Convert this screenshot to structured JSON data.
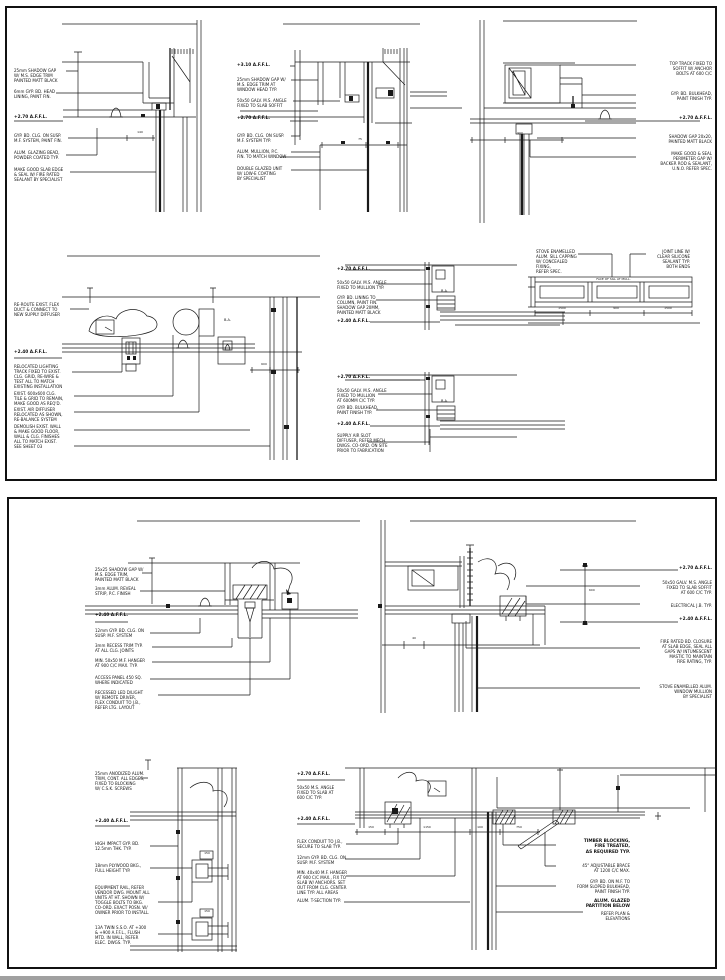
{
  "page": {
    "background": "#ffffff",
    "sheet_border_color": "#111111",
    "line_color": "#1a1a1a",
    "bottom_strip_color": "#a0a0a0"
  },
  "sheet1": {
    "callouts": [
      {
        "name": "d1-note-shadow-gap",
        "x": 14,
        "y": 68,
        "w": 52,
        "text": "25mm SHADOW GAP\nW/ M.S. EDGE TRIM\nPAINTED MATT BLACK"
      },
      {
        "name": "d1-note-head-lining",
        "x": 14,
        "y": 89,
        "w": 52,
        "text": "6mm GYP. BD. HEAD\nLINING, PAINT FIN."
      },
      {
        "name": "d1-level-affl",
        "x": 14,
        "y": 115,
        "w": 52,
        "bold": true,
        "text": "+2.70 A.F.F.L."
      },
      {
        "name": "d1-note-ceiling",
        "x": 14,
        "y": 133,
        "w": 56,
        "text": "GYP. BD. CLG. ON SUSP.\nM.F. SYSTEM, PAINT FIN."
      },
      {
        "name": "d1-note-glazing-bead",
        "x": 14,
        "y": 150,
        "w": 52,
        "text": "ALUM. GLAZING BEAD,\nPOWDER COATED TYP."
      },
      {
        "name": "d1-note-slab-seal",
        "x": 14,
        "y": 167,
        "w": 54,
        "text": "MAKE GOOD SLAB EDGE\n& SEAL W/ FIRE RATED\nSEALANT BY SPECIALIST"
      },
      {
        "name": "d1-dim-head",
        "x": 128,
        "y": 131,
        "w": 24,
        "size": 3,
        "align": "center",
        "text": "140"
      },
      {
        "name": "d2-level-top",
        "x": 237,
        "y": 63,
        "w": 52,
        "bold": true,
        "text": "+3.10 A.F.F.L."
      },
      {
        "name": "d2-note-shadow-gap",
        "x": 237,
        "y": 77,
        "w": 54,
        "text": "25mm SHADOW GAP W/\nM.S. EDGE TRIM AT\nWINDOW HEAD TYP."
      },
      {
        "name": "d2-note-angle",
        "x": 237,
        "y": 98,
        "w": 54,
        "text": "50x50 GALV. M.S. ANGLE\nFIXED TO SLAB SOFFIT"
      },
      {
        "name": "d2-level-affl",
        "x": 237,
        "y": 116,
        "w": 52,
        "bold": true,
        "text": "+2.70 A.F.F.L."
      },
      {
        "name": "d2-note-ceiling",
        "x": 237,
        "y": 133,
        "w": 54,
        "text": "GYP. BD. CLG. ON SUSP.\nM.F. SYSTEM TYP."
      },
      {
        "name": "d2-note-mullion",
        "x": 237,
        "y": 149,
        "w": 54,
        "text": "ALUM. MULLION, P.C.\nFIN. TO MATCH WINDOW"
      },
      {
        "name": "d2-note-glazing",
        "x": 237,
        "y": 166,
        "w": 54,
        "text": "DOUBLE GLAZED UNIT\nW/ LOW-E COATING\nBY SPECIALIST"
      },
      {
        "name": "d2-dim-head",
        "x": 348,
        "y": 138,
        "w": 24,
        "size": 3,
        "align": "center",
        "text": "75"
      },
      {
        "name": "d3-note-track",
        "x": 638,
        "y": 61,
        "w": 74,
        "align": "right",
        "text": "TOP TRACK FIXED TO\nSOFFIT W/ ANCHOR\nBOLTS AT 600 C/C"
      },
      {
        "name": "d3-note-bulkhead",
        "x": 638,
        "y": 91,
        "w": 74,
        "align": "right",
        "text": "GYP. BD. BULKHEAD,\nPAINT FINISH TYP."
      },
      {
        "name": "d3-level-affl",
        "x": 638,
        "y": 116,
        "w": 74,
        "align": "right",
        "bold": true,
        "text": "+2.70 A.F.F.L."
      },
      {
        "name": "d3-note-shadow",
        "x": 638,
        "y": 134,
        "w": 74,
        "align": "right",
        "text": "SHADOW GAP 20x20,\nPAINTED MATT BLACK"
      },
      {
        "name": "d3-note-seal",
        "x": 638,
        "y": 151,
        "w": 74,
        "align": "right",
        "text": "MAKE GOOD & SEAL\nPERIMETER GAP W/\nBACKER ROD & SEALANT,\nU.N.O. REFER SPEC."
      },
      {
        "name": "d3-dim-sill",
        "x": 505,
        "y": 132,
        "w": 30,
        "size": 3,
        "align": "center",
        "text": "900"
      },
      {
        "name": "d4-note-flex",
        "x": 14,
        "y": 302,
        "w": 56,
        "text": "RE-ROUTE EXIST. FLEX\nDUCT & CONNECT TO\nNEW SUPPLY DIFFUSER"
      },
      {
        "name": "d4-level",
        "x": 14,
        "y": 350,
        "w": 52,
        "bold": true,
        "text": "+2.40 A.F.F.L."
      },
      {
        "name": "d4-note-track",
        "x": 14,
        "y": 364,
        "w": 58,
        "text": "RELOCATED LIGHTING\nTRACK FIXED TO EXIST.\nCLG. GRID, RE-WIRE &\nTEST ALL TO MATCH\nEXISTING INSTALLATION"
      },
      {
        "name": "d4-note-tile",
        "x": 14,
        "y": 391,
        "w": 58,
        "text": "EXIST. 600x600 CLG.\nTILE & GRID TO REMAIN,\nMAKE GOOD AS REQ'D."
      },
      {
        "name": "d4-note-diffuser",
        "x": 14,
        "y": 407,
        "w": 58,
        "text": "EXIST. AIR DIFFUSER\nRELOCATED AS SHOWN,\nRE-BALANCE SYSTEM"
      },
      {
        "name": "d4-note-demolish",
        "x": 14,
        "y": 424,
        "w": 58,
        "text": "DEMOLISH EXIST. WALL\n& MAKE GOOD FLOOR,\nWALL & CLG. FINISHES\nALL TO MATCH EXIST.\nSEE SHEET 03"
      },
      {
        "name": "d4-label-ba",
        "x": 224,
        "y": 318,
        "w": 18,
        "size": 3.5,
        "text": "B.A."
      },
      {
        "name": "d4-dim-wall",
        "x": 252,
        "y": 363,
        "w": 24,
        "size": 3,
        "align": "center",
        "text": "600"
      },
      {
        "name": "d5-level-top",
        "x": 337,
        "y": 267,
        "w": 50,
        "bold": true,
        "text": "+2.70 A.F.F.L."
      },
      {
        "name": "d5-note-angle",
        "x": 337,
        "y": 280,
        "w": 54,
        "text": "50x50 GALV. M.S. ANGLE\nFIXED TO MULLION TYP."
      },
      {
        "name": "d5-note-lining",
        "x": 337,
        "y": 295,
        "w": 54,
        "text": "GYP. BD. LINING TO\nCOLUMN, PAINT FIN.\nSHADOW GAP 20MM,\nPAINTED MATT BLACK"
      },
      {
        "name": "d5-level-clg",
        "x": 337,
        "y": 319,
        "w": 50,
        "bold": true,
        "text": "+2.40 A.F.F.L."
      },
      {
        "name": "d5-label-ba",
        "x": 441,
        "y": 289,
        "w": 16,
        "size": 3.5,
        "text": "B.A."
      },
      {
        "name": "d6-level-top",
        "x": 337,
        "y": 375,
        "w": 50,
        "bold": true,
        "text": "+2.70 A.F.F.L."
      },
      {
        "name": "d6-note-angle",
        "x": 337,
        "y": 388,
        "w": 54,
        "text": "50x50 GALV. M.S. ANGLE\nFIXED TO MULLION\nAT 600MM C/C TYP."
      },
      {
        "name": "d6-note-bulkhead",
        "x": 337,
        "y": 405,
        "w": 54,
        "text": "GYP. BD. BULKHEAD,\nPAINT FINISH TYP."
      },
      {
        "name": "d6-level-clg",
        "x": 337,
        "y": 422,
        "w": 50,
        "bold": true,
        "text": "+2.40 A.F.F.L."
      },
      {
        "name": "d6-note-slot",
        "x": 337,
        "y": 433,
        "w": 54,
        "text": "SUPPLY AIR SLOT\nDIFFUSER, REFER MECH.\nDWGS. CO-ORD. ON SITE\nPRIOR TO FABRICATION"
      },
      {
        "name": "d6-label-ba",
        "x": 441,
        "y": 399,
        "w": 16,
        "size": 3.5,
        "text": "B.A."
      },
      {
        "name": "d7-note-capping",
        "x": 536,
        "y": 249,
        "w": 44,
        "text": "STOVE ENAMELLED\nALUM. SILL CAPPING\nW/ CONCEALED FIXING,\nREFER SPEC."
      },
      {
        "name": "d7-note-joint",
        "x": 646,
        "y": 249,
        "w": 44,
        "align": "right",
        "text": "JOINT LINE W/\nCLEAR SILICONE\nSEALANT TYP.\nBOTH ENDS"
      },
      {
        "name": "d7-note-face",
        "x": 566,
        "y": 278,
        "w": 95,
        "size": 3,
        "align": "center",
        "text": "FACE OF SILL AT MULL."
      },
      {
        "name": "d7-dim-1",
        "x": 540,
        "y": 307,
        "w": 44,
        "size": 3,
        "align": "center",
        "text": "1500"
      },
      {
        "name": "d7-dim-2",
        "x": 594,
        "y": 307,
        "w": 44,
        "size": 3,
        "align": "center",
        "text": "900"
      },
      {
        "name": "d7-dim-3",
        "x": 646,
        "y": 307,
        "w": 44,
        "size": 3,
        "align": "center",
        "text": "1500"
      }
    ]
  },
  "sheet2": {
    "callouts": [
      {
        "name": "d8-note-shadow",
        "x": 95,
        "y": 567,
        "w": 54,
        "text": "25x25 SHADOW GAP W/\nM.S. EDGE TRIM,\nPAINTED MATT BLACK"
      },
      {
        "name": "d8-note-reveal",
        "x": 95,
        "y": 586,
        "w": 54,
        "text": "3mm ALUM. REVEAL\nSTRIP, P.C. FINISH"
      },
      {
        "name": "d8-level",
        "x": 95,
        "y": 613,
        "w": 50,
        "bold": true,
        "text": "+2.40 A.F.F.L."
      },
      {
        "name": "d8-note-clg",
        "x": 95,
        "y": 628,
        "w": 56,
        "text": "12mm GYP. BD. CLG. ON\nSUSP. M.F. SYSTEM"
      },
      {
        "name": "d8-note-trim",
        "x": 95,
        "y": 643,
        "w": 56,
        "text": "3mm RECESS TRIM TYP.\nAT ALL CLG. JOINTS"
      },
      {
        "name": "d8-note-hanger",
        "x": 95,
        "y": 658,
        "w": 56,
        "text": "MIN. 50x50 M.F. HANGER\nAT 900 C/C MAX. TYP."
      },
      {
        "name": "d8-note-access",
        "x": 95,
        "y": 675,
        "w": 56,
        "text": "ACCESS PANEL 450 SQ.\nWHERE INDICATED"
      },
      {
        "name": "d8-note-downlight",
        "x": 95,
        "y": 690,
        "w": 58,
        "text": "RECESSED LED D/LIGHT\nW/ REMOTE DRIVER,\nFLEX CONDUIT TO J.B.,\nREFER LTG. LAYOUT"
      },
      {
        "name": "d9-level-top",
        "x": 642,
        "y": 566,
        "w": 70,
        "align": "right",
        "bold": true,
        "text": "+2.70 A.F.F.L."
      },
      {
        "name": "d9-note-angle",
        "x": 642,
        "y": 580,
        "w": 70,
        "align": "right",
        "text": "50x50 GALV. M.S. ANGLE\nFIXED TO SLAB SOFFIT\nAT 600 C/C TYP."
      },
      {
        "name": "d9-note-jb",
        "x": 642,
        "y": 603,
        "w": 70,
        "align": "right",
        "text": "ELECTRICAL J.B. TYP."
      },
      {
        "name": "d9-level-clg",
        "x": 642,
        "y": 617,
        "w": 70,
        "align": "right",
        "bold": true,
        "text": "+2.40 A.F.F.L."
      },
      {
        "name": "d9-note-fire",
        "x": 642,
        "y": 639,
        "w": 70,
        "align": "right",
        "text": "FIRE RATED BD. CLOSURE\nAT SLAB EDGE, SEAL ALL\nGAPS W/ INTUMESCENT\nMASTIC TO MAINTAIN\nFIRE RATING, TYP."
      },
      {
        "name": "d9-note-mullion",
        "x": 642,
        "y": 684,
        "w": 70,
        "align": "right",
        "text": "STOVE ENAMELLED ALUM.\nWINDOW MULLION\nBY SPECIALIST"
      },
      {
        "name": "d9-dim-jamb",
        "x": 400,
        "y": 637,
        "w": 28,
        "size": 3,
        "align": "center",
        "text": "40"
      },
      {
        "name": "d9-dim-drop",
        "x": 589,
        "y": 589,
        "w": 14,
        "size": 3,
        "text": "600"
      },
      {
        "name": "d10-note-trim",
        "x": 95,
        "y": 771,
        "w": 56,
        "text": "25mm ANODIZED ALUM.\nTRIM, CONT. ALL EDGES,\nFIXED TO BLOCKING\nW/ C.S.K. SCREWS"
      },
      {
        "name": "d10-level",
        "x": 95,
        "y": 819,
        "w": 50,
        "bold": true,
        "text": "+2.40 A.F.F.L."
      },
      {
        "name": "d10-note-gypbd",
        "x": 95,
        "y": 841,
        "w": 56,
        "text": "HIGH IMPACT GYP. BD.\n12.5mm THK. TYP."
      },
      {
        "name": "d10-note-plywood",
        "x": 95,
        "y": 863,
        "w": 56,
        "text": "18mm PLYWOOD BKG.,\nFULL HEIGHT TYP."
      },
      {
        "name": "d10-note-equipment",
        "x": 95,
        "y": 885,
        "w": 60,
        "text": "EQUIPMENT RAIL, REFER\nVENDOR DWG. MOUNT ALL\nUNITS AT HT. SHOWN W/\nTOGGLE BOLTS TO BKG.\nCO-ORD. EXACT POSN. W/\nOWNER PRIOR TO INSTALL."
      },
      {
        "name": "d10-note-socket",
        "x": 95,
        "y": 925,
        "w": 60,
        "text": "13A TWIN S.S.O. AT +300\n& +900 A.F.F.L., FLUSH\nMTD. IN WALL, REFER\nELEC. DWGS. TYP."
      },
      {
        "name": "d10-dim-1",
        "x": 198,
        "y": 852,
        "w": 18,
        "size": 3,
        "align": "center",
        "text": "150"
      },
      {
        "name": "d10-dim-2",
        "x": 198,
        "y": 910,
        "w": 18,
        "size": 3,
        "align": "center",
        "text": "150"
      },
      {
        "name": "d11-level-top",
        "x": 297,
        "y": 772,
        "w": 48,
        "bold": true,
        "text": "+2.70 A.F.F.L."
      },
      {
        "name": "d11-note-angle",
        "x": 297,
        "y": 785,
        "w": 50,
        "text": "50x50 M.S. ANGLE\nFIXED TO SLAB AT\n600 C/C TYP."
      },
      {
        "name": "d11-level-clg",
        "x": 297,
        "y": 817,
        "w": 48,
        "bold": true,
        "text": "+2.40 A.F.F.L."
      },
      {
        "name": "d11-note-flex",
        "x": 297,
        "y": 839,
        "w": 54,
        "text": "FLEX CONDUIT TO J.B.,\nSECURE TO SLAB TYP."
      },
      {
        "name": "d11-note-clg",
        "x": 297,
        "y": 855,
        "w": 54,
        "text": "12mm GYP. BD. CLG. ON\nSUSP. M.F. SYSTEM"
      },
      {
        "name": "d11-note-hanger",
        "x": 297,
        "y": 870,
        "w": 56,
        "text": "MIN. 40x40 M.F. HANGER\nAT 900 C/C MAX., FIX TO\nSLAB W/ ANCHORS. SET\nOUT FROM CLG. CENTER\nLINE TYP. ALL AREAS"
      },
      {
        "name": "d11-note-tsection",
        "x": 297,
        "y": 898,
        "w": 54,
        "text": "ALUM. T-SECTION TYP."
      },
      {
        "name": "d11-note-blocking",
        "x": 560,
        "y": 839,
        "w": 70,
        "align": "right",
        "bold": true,
        "text": "TIMBER BLOCKING,\nFIRE TREATED,\nAS REQUIRED TYP."
      },
      {
        "name": "d11-note-brace",
        "x": 560,
        "y": 863,
        "w": 70,
        "align": "right",
        "text": "45° ADJUSTABLE BRACE\nAT 1200 C/C MAX."
      },
      {
        "name": "d11-note-bulkhead",
        "x": 560,
        "y": 879,
        "w": 70,
        "align": "right",
        "text": "GYP. BD. ON M.F. TO\nFORM SLOPED BULKHEAD,\nPAINT FINISH TYP."
      },
      {
        "name": "d11-note-partition",
        "x": 560,
        "y": 899,
        "w": 70,
        "align": "right",
        "bold": true,
        "text": "ALUM. GLAZED\nPARTITION BELOW"
      },
      {
        "name": "d11-note-partition2",
        "x": 560,
        "y": 911,
        "w": 70,
        "align": "right",
        "text": "REFER PLAN &\nELEVATIONS"
      },
      {
        "name": "d11-dim-1",
        "x": 357,
        "y": 826,
        "w": 28,
        "size": 3,
        "align": "center",
        "text": "150"
      },
      {
        "name": "d11-dim-2",
        "x": 392,
        "y": 826,
        "w": 70,
        "size": 3,
        "align": "center",
        "text": "1150"
      },
      {
        "name": "d11-dim-3",
        "x": 462,
        "y": 826,
        "w": 36,
        "size": 3,
        "align": "center",
        "text": "100"
      },
      {
        "name": "d11-dim-4",
        "x": 498,
        "y": 826,
        "w": 42,
        "size": 3,
        "align": "center",
        "text": "750"
      }
    ]
  }
}
